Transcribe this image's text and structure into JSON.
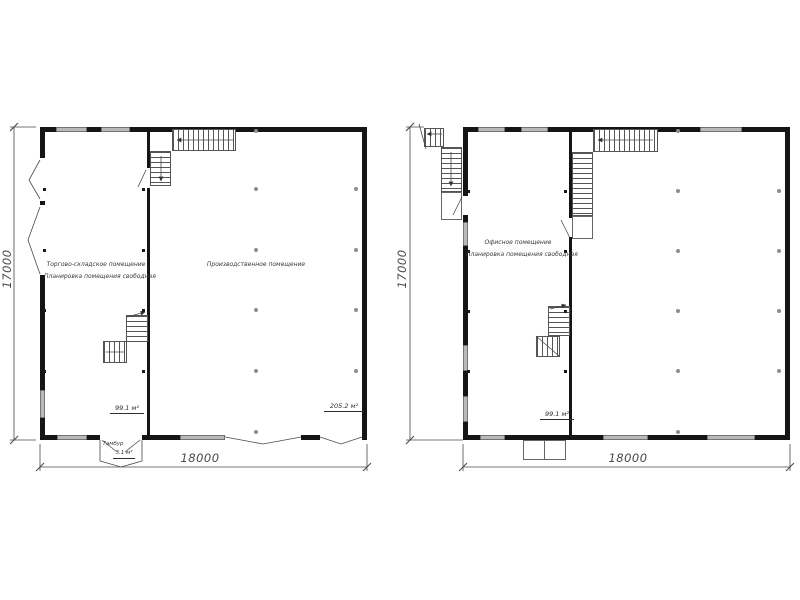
{
  "plan_left": {
    "room1_name": "Торгово-складское помещение",
    "room1_note": "Планировка помещения свободная",
    "room1_area": "99.1 м²",
    "room2_name": "Производственное помещение",
    "room2_area": "205.2 м²",
    "vestibule_name": "Тамбур",
    "vestibule_area": "3.1 м²",
    "width_dim": "18000",
    "height_dim": "17000"
  },
  "plan_right": {
    "room1_name": "Офисное помещение",
    "room1_note": "Планировка помещения свободная",
    "room1_area": "99.1 м²",
    "width_dim": "18000",
    "height_dim": "17000"
  }
}
